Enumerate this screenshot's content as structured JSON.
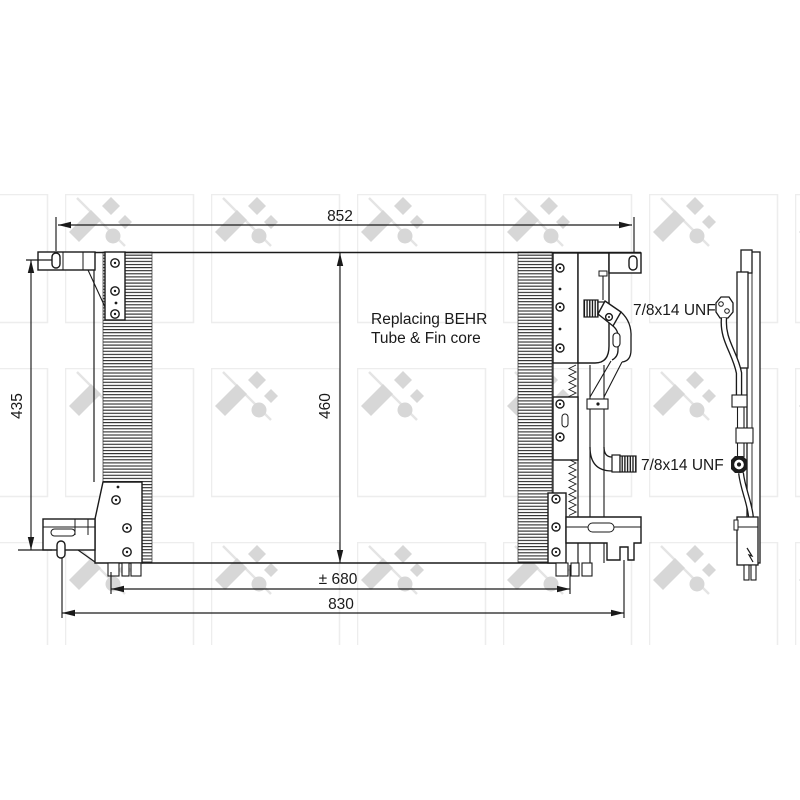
{
  "page": {
    "background": "#ffffff"
  },
  "drawing": {
    "dimensions": {
      "overall_width": "852",
      "left_height": "435",
      "core_height": "460",
      "mounting_width": "± 680",
      "bottom_width": "830"
    },
    "annotations": {
      "note_line1": "Replacing BEHR",
      "note_line2": "Tube & Fin core",
      "fitting_top": "7/8x14 UNF",
      "fitting_bottom": "7/8x14 UNF"
    },
    "colors": {
      "line": "#1a1a1a",
      "watermark_logo": "#d7d7d7",
      "watermark_box": "#ededed"
    }
  }
}
